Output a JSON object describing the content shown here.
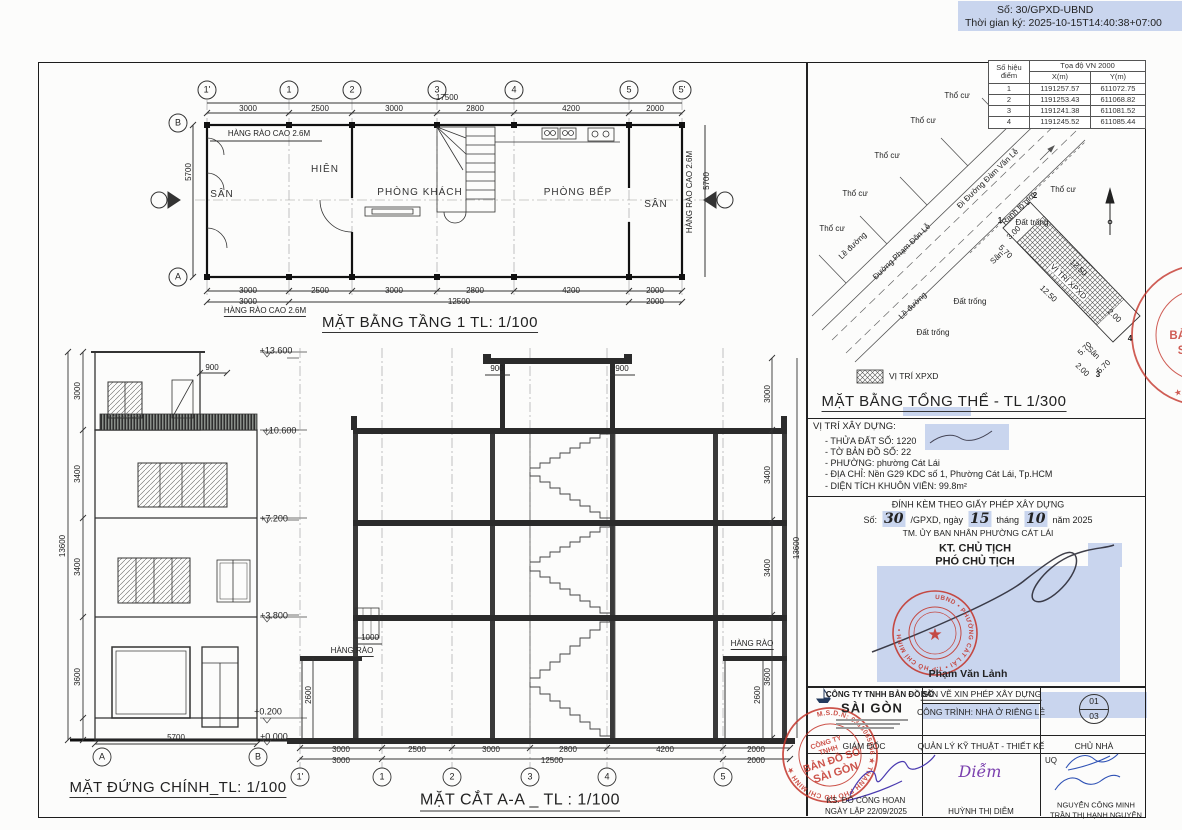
{
  "doc_header": {
    "line1": "Số: 30/GPXD-UBND",
    "line2": "Thời gian ký: 2025-10-15T14:40:38+07:00"
  },
  "coord_table": {
    "header_point": "Số hiệu điểm",
    "header_group": "Tọa độ VN 2000",
    "header_x": "X(m)",
    "header_y": "Y(m)",
    "rows": [
      {
        "id": "1",
        "x": "1191257.57",
        "y": "611072.75"
      },
      {
        "id": "2",
        "x": "1191253.43",
        "y": "611068.82"
      },
      {
        "id": "3",
        "x": "1191241.38",
        "y": "611081.52"
      },
      {
        "id": "4",
        "x": "1191245.52",
        "y": "611085.44"
      }
    ]
  },
  "site": {
    "thocu": "Thổ cư",
    "dattrong": "Đất trống",
    "leduong": "Lề đường",
    "san": "Sân",
    "road1": "Đường Phạm Đôn Lễ",
    "road2": "Đi Đường Đàm Văn Lễ",
    "ranh": "Ranh lộ giới",
    "parcel": "VỊ TRÍ XPXD",
    "d570": "5.70",
    "d1250": "12.50",
    "d200": "2.00",
    "d300": "3.00",
    "p": [
      "1",
      "2",
      "3",
      "4"
    ],
    "legend": "VỊ TRÍ XPXD",
    "title": "MẶT BẰNG TỔNG THỂ - TL 1/300"
  },
  "build_info": {
    "title": "VỊ TRÍ XÂY DỰNG:",
    "lines": [
      "- THỬA ĐẤT SỐ: 1220",
      "- TỜ BẢN ĐỒ SỐ:  22",
      "- PHƯỜNG: phường Cát Lái",
      "- ĐỊA CHỈ:   Nền G29 KDC số 1, Phường Cát Lái, Tp.HCM",
      "- DIỆN TÍCH KHUÔN VIÊN:  99.8m²"
    ]
  },
  "permit": {
    "attach_line": "ĐÍNH KÈM THEO GIẤY PHÉP XÂY DỰNG",
    "no_prefix": "Số:",
    "no_value": "30",
    "no_mid": "/GPXD, ngày",
    "day": "15",
    "month_label": "tháng",
    "month": "10",
    "year_label": "năm 2025",
    "tm_line": "TM. ỦY BAN NHÂN PHƯỜNG CÁT LÁI",
    "kt_line": "KT. CHỦ TỊCH",
    "pho_line": "PHÓ CHỦ TỊCH",
    "signer": "Phạm Văn Lảnh",
    "stamp_ring": "UBND • PHƯỜNG CÁT LÁI • T.P HỒ CHÍ MINH •",
    "stamp_star": "★"
  },
  "title_block": {
    "company_line1": "CÔNG TY TNHH BẢN ĐỒ SỐ",
    "company_line2": "SÀI GÒN",
    "doc_type": "BẢN VẼ XIN PHÉP XÂY DỰNG",
    "project": "CÔNG TRÌNH: NHÀ Ở RIÊNG LẺ",
    "sheet_no": "01",
    "sheet_total": "03",
    "col_headers": [
      "GIÁM ĐỐC",
      "QUẢN LÝ KỸ THUẬT - THIẾT KẾ",
      "CHỦ NHÀ"
    ],
    "director_name": "KS. ĐỖ CÔNG HOAN",
    "created_date": "NGÀY LẬP 22/09/2025",
    "designer_sig": "Diễm",
    "designer_name": "HUỲNH THỊ DIỄM",
    "uq": "UQ",
    "owner_name1": "NGUYỄN CÔNG MINH",
    "owner_name2": "TRẦN THỊ HẠNH NGUYÊN",
    "stamp_ring": "M.S.D.N: 0318065956 ★ THÀNH PHỐ HỒ CHÍ MINH ★",
    "stamp_center": [
      "CÔNG TY",
      "TNHH",
      "BẢN ĐỒ SỐ",
      "SÀI GÒN"
    ]
  },
  "fp": {
    "title": "MẶT BẰNG TẦNG 1 TL: 1/100",
    "grid": [
      "1'",
      "1",
      "2",
      "3",
      "4",
      "5",
      "5'"
    ],
    "ga": "A",
    "gb": "B",
    "total": "17500",
    "d": [
      "3000",
      "2500",
      "3000",
      "2800",
      "4200",
      "2000"
    ],
    "d2": [
      "3000",
      "12500",
      "2000"
    ],
    "v": "5700",
    "rooms": {
      "san_l": "SÂN",
      "hien": "HIÊN",
      "khach": "PHÒNG KHÁCH",
      "bep": "PHÒNG BẾP",
      "san_r": "SÂN"
    },
    "fence": "HÀNG RÀO CAO 2.6M"
  },
  "el": {
    "title": "MẶT ĐỨNG CHÍNH_TL: 1/100",
    "lv": [
      "+13.600",
      "+10.600",
      "+7.200",
      "+3.800",
      "+0.200",
      "±0.000"
    ],
    "dl": [
      "3000",
      "3400",
      "3400",
      "3600"
    ],
    "total": "13600",
    "d900": "900",
    "db": "5700",
    "ga": "A",
    "gb": "B"
  },
  "sec": {
    "title": "MẶT CẮT A-A _ TL : 1/100",
    "d900": "900",
    "fence": "HÀNG RÀO",
    "d1000": "1000",
    "d2600": "2600",
    "dr": [
      "3000",
      "3400",
      "3400",
      "3600"
    ],
    "total": "13600",
    "d": [
      "3000",
      "2500",
      "3000",
      "2800",
      "4200",
      "2000"
    ],
    "d2": [
      "3000",
      "12500",
      "2000"
    ],
    "grid": [
      "1'",
      "1",
      "2",
      "3",
      "4",
      "5"
    ]
  },
  "colors": {
    "highlight": "#c9d5ee",
    "stamp_red": "#c4362c",
    "line": "#2f2f2f"
  }
}
